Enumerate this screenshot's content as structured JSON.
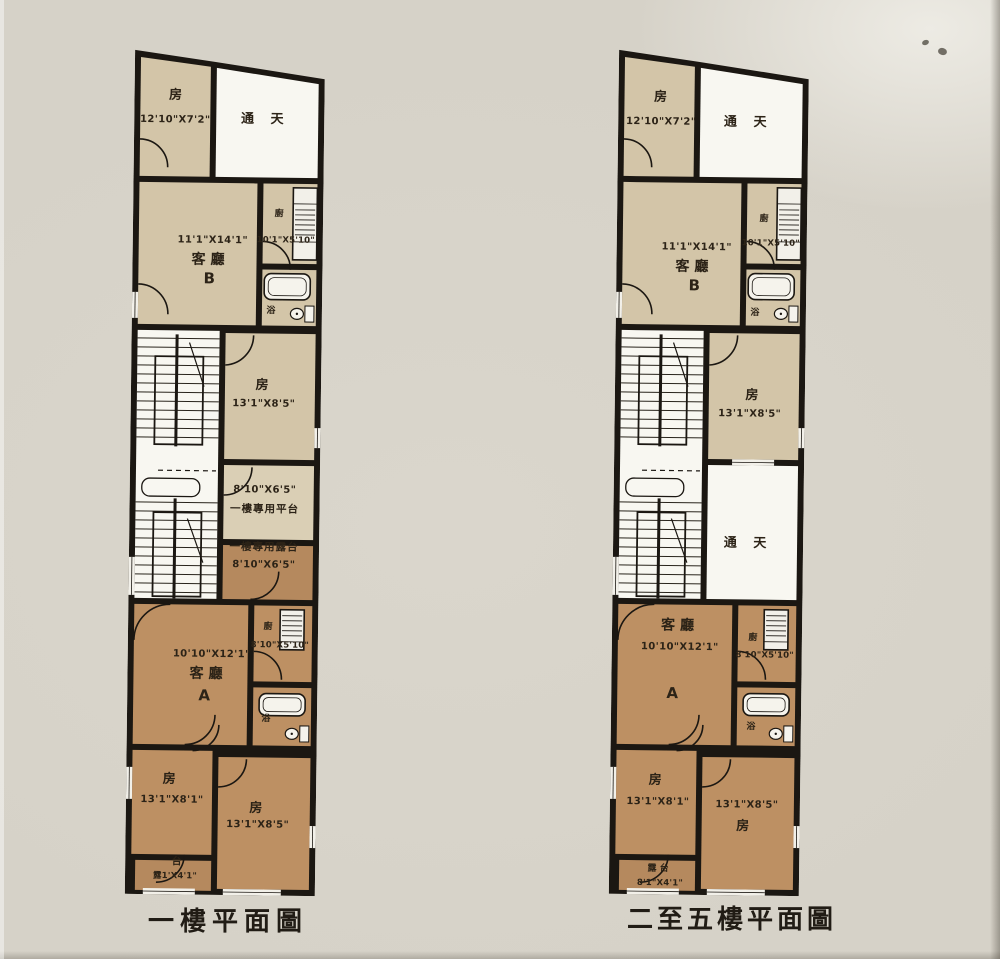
{
  "document": {
    "type": "scanned floor plan sheet",
    "captions": [
      "一樓平面圖",
      "二至五樓平面圖"
    ]
  },
  "colors": {
    "background": "#d6d2c8",
    "room_beige": "#d3c5a8",
    "room_brown": "#bd9063",
    "terrace_brown": "#b5895e",
    "platform_light": "#dacfb5",
    "void_white": "#f8f7f1",
    "wall": "#1b1712"
  },
  "plans": [
    {
      "caption": "一樓平面圖",
      "labels": {
        "bedroom_top_name": "房",
        "bedroom_top_dims": "12'10\"X7'2\"",
        "skylight_top": "通 天",
        "living_b_dims": "11'1\"X14'1\"",
        "living_b_name": "客廳",
        "living_b_unit": "B",
        "kitchen_b_name": "廚",
        "kitchen_b_dims": "10'1\"X5'10\"",
        "bath_b_name": "浴",
        "bedroom_mid_name": "房",
        "bedroom_mid_dims": "13'1\"X8'5\"",
        "mid_upper_dims": "8'10\"X6'5\"",
        "mid_upper_name": "一樓專用平台",
        "mid_lower_name": "一樓專用露台",
        "mid_lower_dims": "8'10\"X6'5\"",
        "living_a_dims": "10'10\"X12'1\"",
        "living_a_name": "客廳",
        "living_a_unit": "A",
        "kitchen_a_name": "廚",
        "kitchen_a_dims": "8'10\"X5'10\"",
        "bath_a_name": "浴",
        "bedroom_bl_name": "房",
        "bedroom_bl_dims": "13'1\"X8'1\"",
        "bedroom_br_name": "房",
        "bedroom_br_dims": "13'1\"X8'5\"",
        "terrace_line1": "台",
        "terrace_line2": "露1'X4'1\""
      }
    },
    {
      "caption": "二至五樓平面圖",
      "labels": {
        "bedroom_top_name": "房",
        "bedroom_top_dims": "12'10\"X7'2\"",
        "skylight_top": "通 天",
        "living_b_dims": "11'1\"X14'1\"",
        "living_b_name": "客廳",
        "living_b_unit": "B",
        "kitchen_b_name": "廚",
        "kitchen_b_dims": "10'1\"X5'10\"",
        "bath_b_name": "浴",
        "bedroom_mid_name": "房",
        "bedroom_mid_dims": "13'1\"X8'5\"",
        "mid_name": "通 天",
        "living_a_name": "客廳",
        "living_a_dims": "10'10\"X12'1\"",
        "living_a_unit": "A",
        "kitchen_a_name": "廚",
        "kitchen_a_dims": "8'10\"X5'10\"",
        "bath_a_name": "浴",
        "bedroom_bl_name": "房",
        "bedroom_bl_dims": "13'1\"X8'1\"",
        "bedroom_br_dims": "13'1\"X8'5\"",
        "bedroom_br_name": "房",
        "terrace_line1": "露 台",
        "terrace_line2": "8'1\"X4'1\""
      }
    }
  ]
}
